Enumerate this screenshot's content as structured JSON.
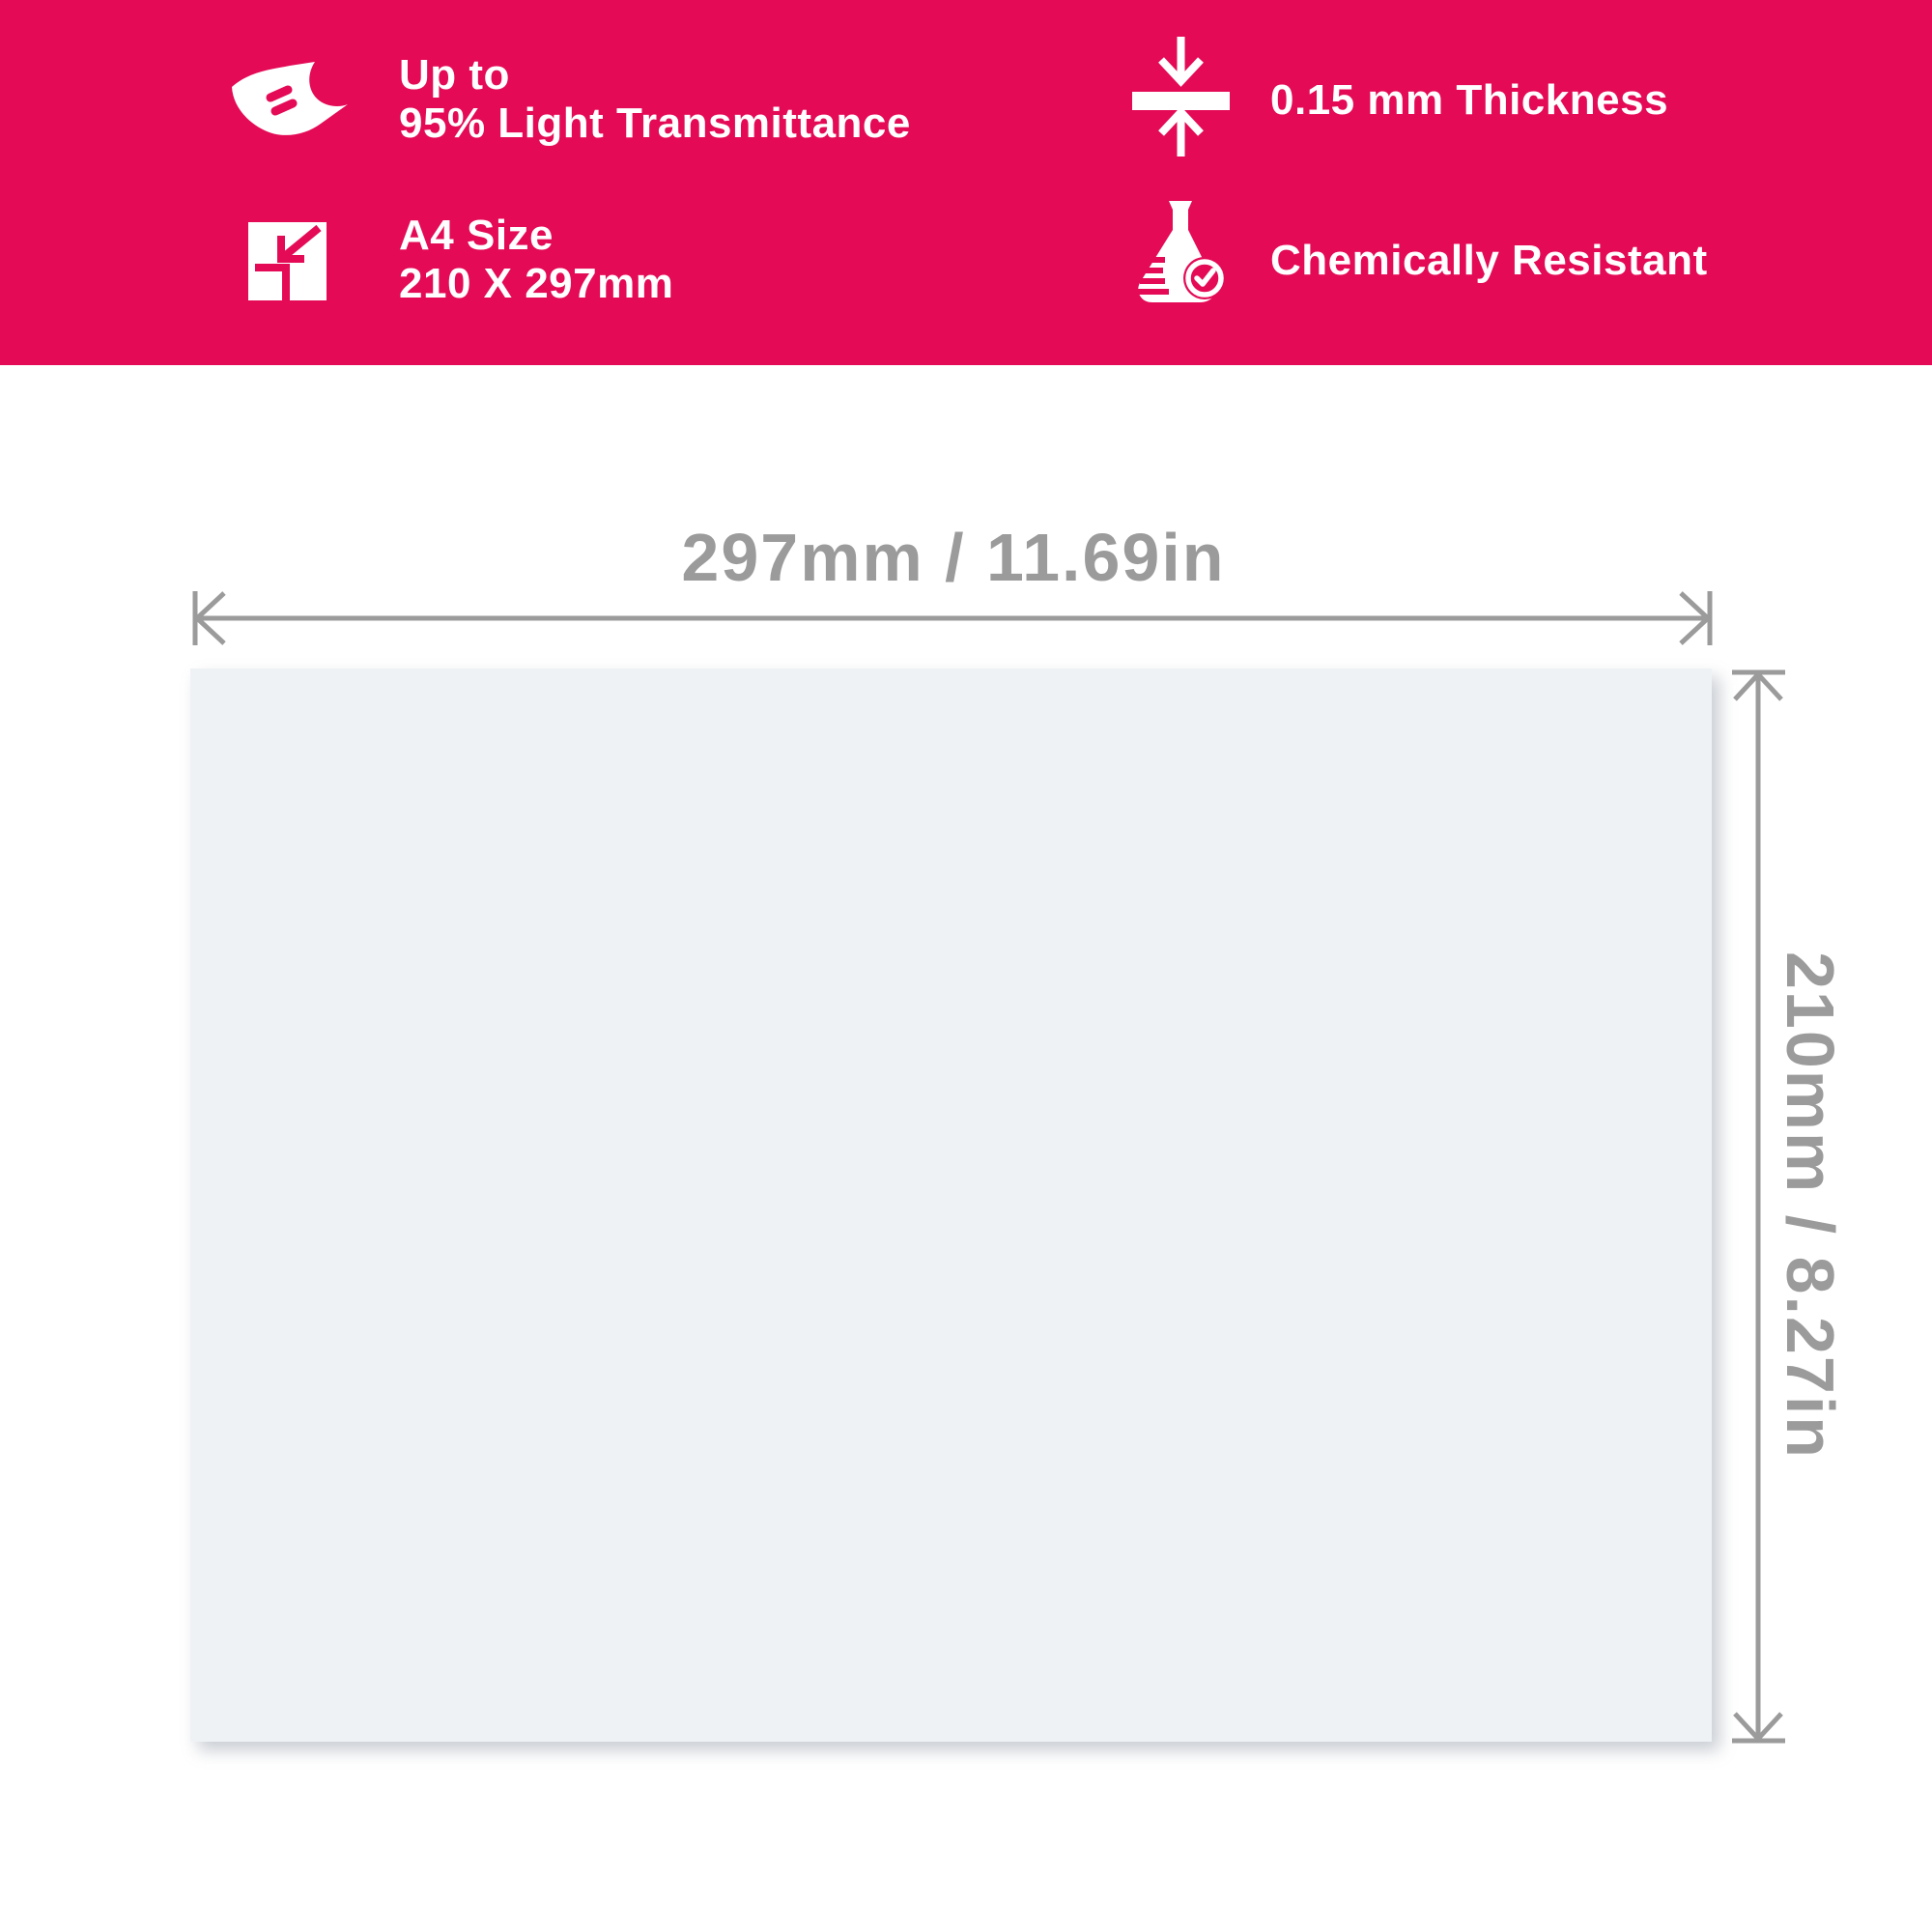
{
  "banner": {
    "features": [
      {
        "name": "light-transmittance",
        "line1": "Up to",
        "line2": "95% Light Transmittance"
      },
      {
        "name": "a4-size",
        "line1": "A4 Size",
        "line2": "210 X 297mm"
      },
      {
        "name": "thickness",
        "line1": "0.15 mm Thickness",
        "line2": ""
      },
      {
        "name": "chemically-resistant",
        "line1": "Chemically Resistant",
        "line2": ""
      }
    ]
  },
  "diagram": {
    "width_label": "297mm / 11.69in",
    "height_label": "210mm / 8.27in"
  },
  "colors": {
    "banner_bg": "#E40A56",
    "banner_text": "#FFFFFF",
    "sheet_fill": "#EFF2F5",
    "dimension_gray": "#9B9B9B"
  }
}
